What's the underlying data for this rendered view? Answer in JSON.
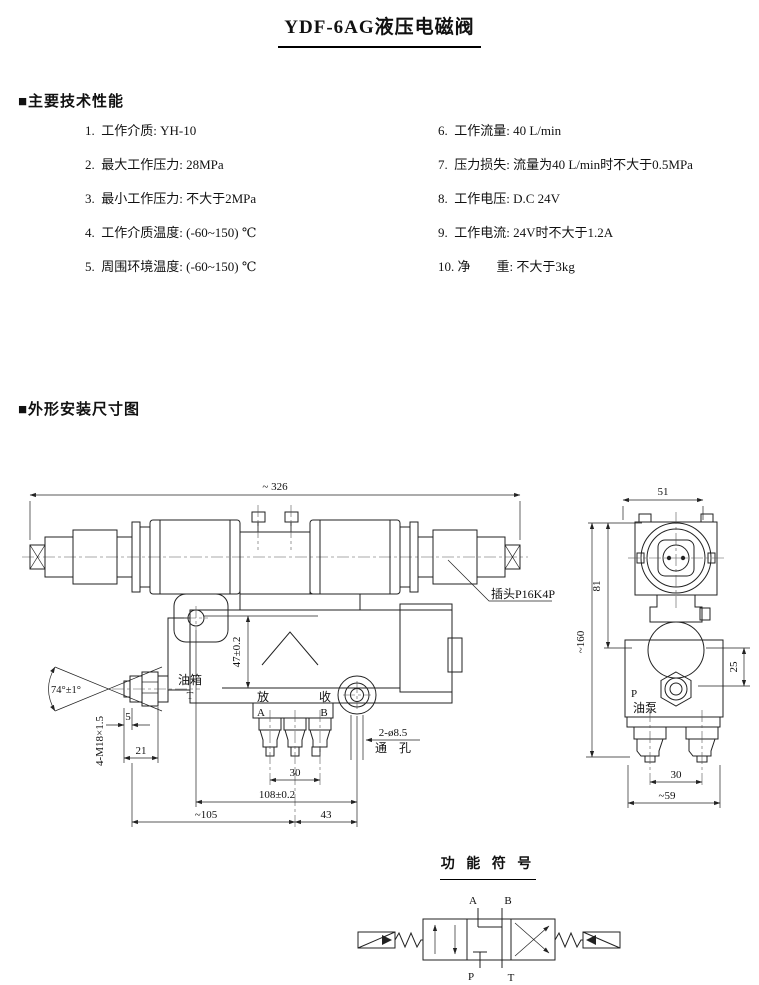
{
  "title": "YDF-6AG液压电磁阀",
  "specs": {
    "heading": "■主要技术性能",
    "left": [
      "1.  工作介质: YH-10",
      "2.  最大工作压力: 28MPa",
      "3.  最小工作压力: 不大于2MPa",
      "4.  工作介质温度: (-60~150) ℃",
      "5.  周围环境温度: (-60~150) ℃"
    ],
    "right": [
      "6.  工作流量: 40 L/min",
      "7.  压力损失: 流量为40 L/min时不大于0.5MPa",
      "8.  工作电压: D.C 24V",
      "9.  工作电流: 24V时不大于1.2A",
      "10. 净　　重: 不大于3kg"
    ]
  },
  "outline": {
    "heading": "■外形安装尺寸图",
    "front": {
      "dim_total_width": "~ 326",
      "dim_height_47": "47±0.2",
      "label_tank": "油箱",
      "port_t": "T",
      "label_release": "放",
      "port_a": "A",
      "label_collect": "收",
      "port_b": "B",
      "dim_5": "5",
      "dim_21": "21",
      "dim_angle": "74°±1°",
      "thread_spec": "4-M18×1.5",
      "dim_30": "30",
      "dim_108": "108±0.2",
      "dim_105": "~105",
      "dim_43": "43",
      "hole_spec_line1": "2-ø8.5",
      "hole_spec_line2": "通　孔",
      "plug_label": "插头P16K4P"
    },
    "side": {
      "dim_51": "51",
      "dim_81": "81",
      "dim_160": "~160",
      "dim_25": "25",
      "port_p": "P",
      "label_pump": "油泵",
      "dim_30": "30",
      "dim_59": "~59"
    }
  },
  "symbol": {
    "heading": "功 能 符 号",
    "port_a": "A",
    "port_b": "B",
    "port_p": "P",
    "port_t": "T"
  }
}
